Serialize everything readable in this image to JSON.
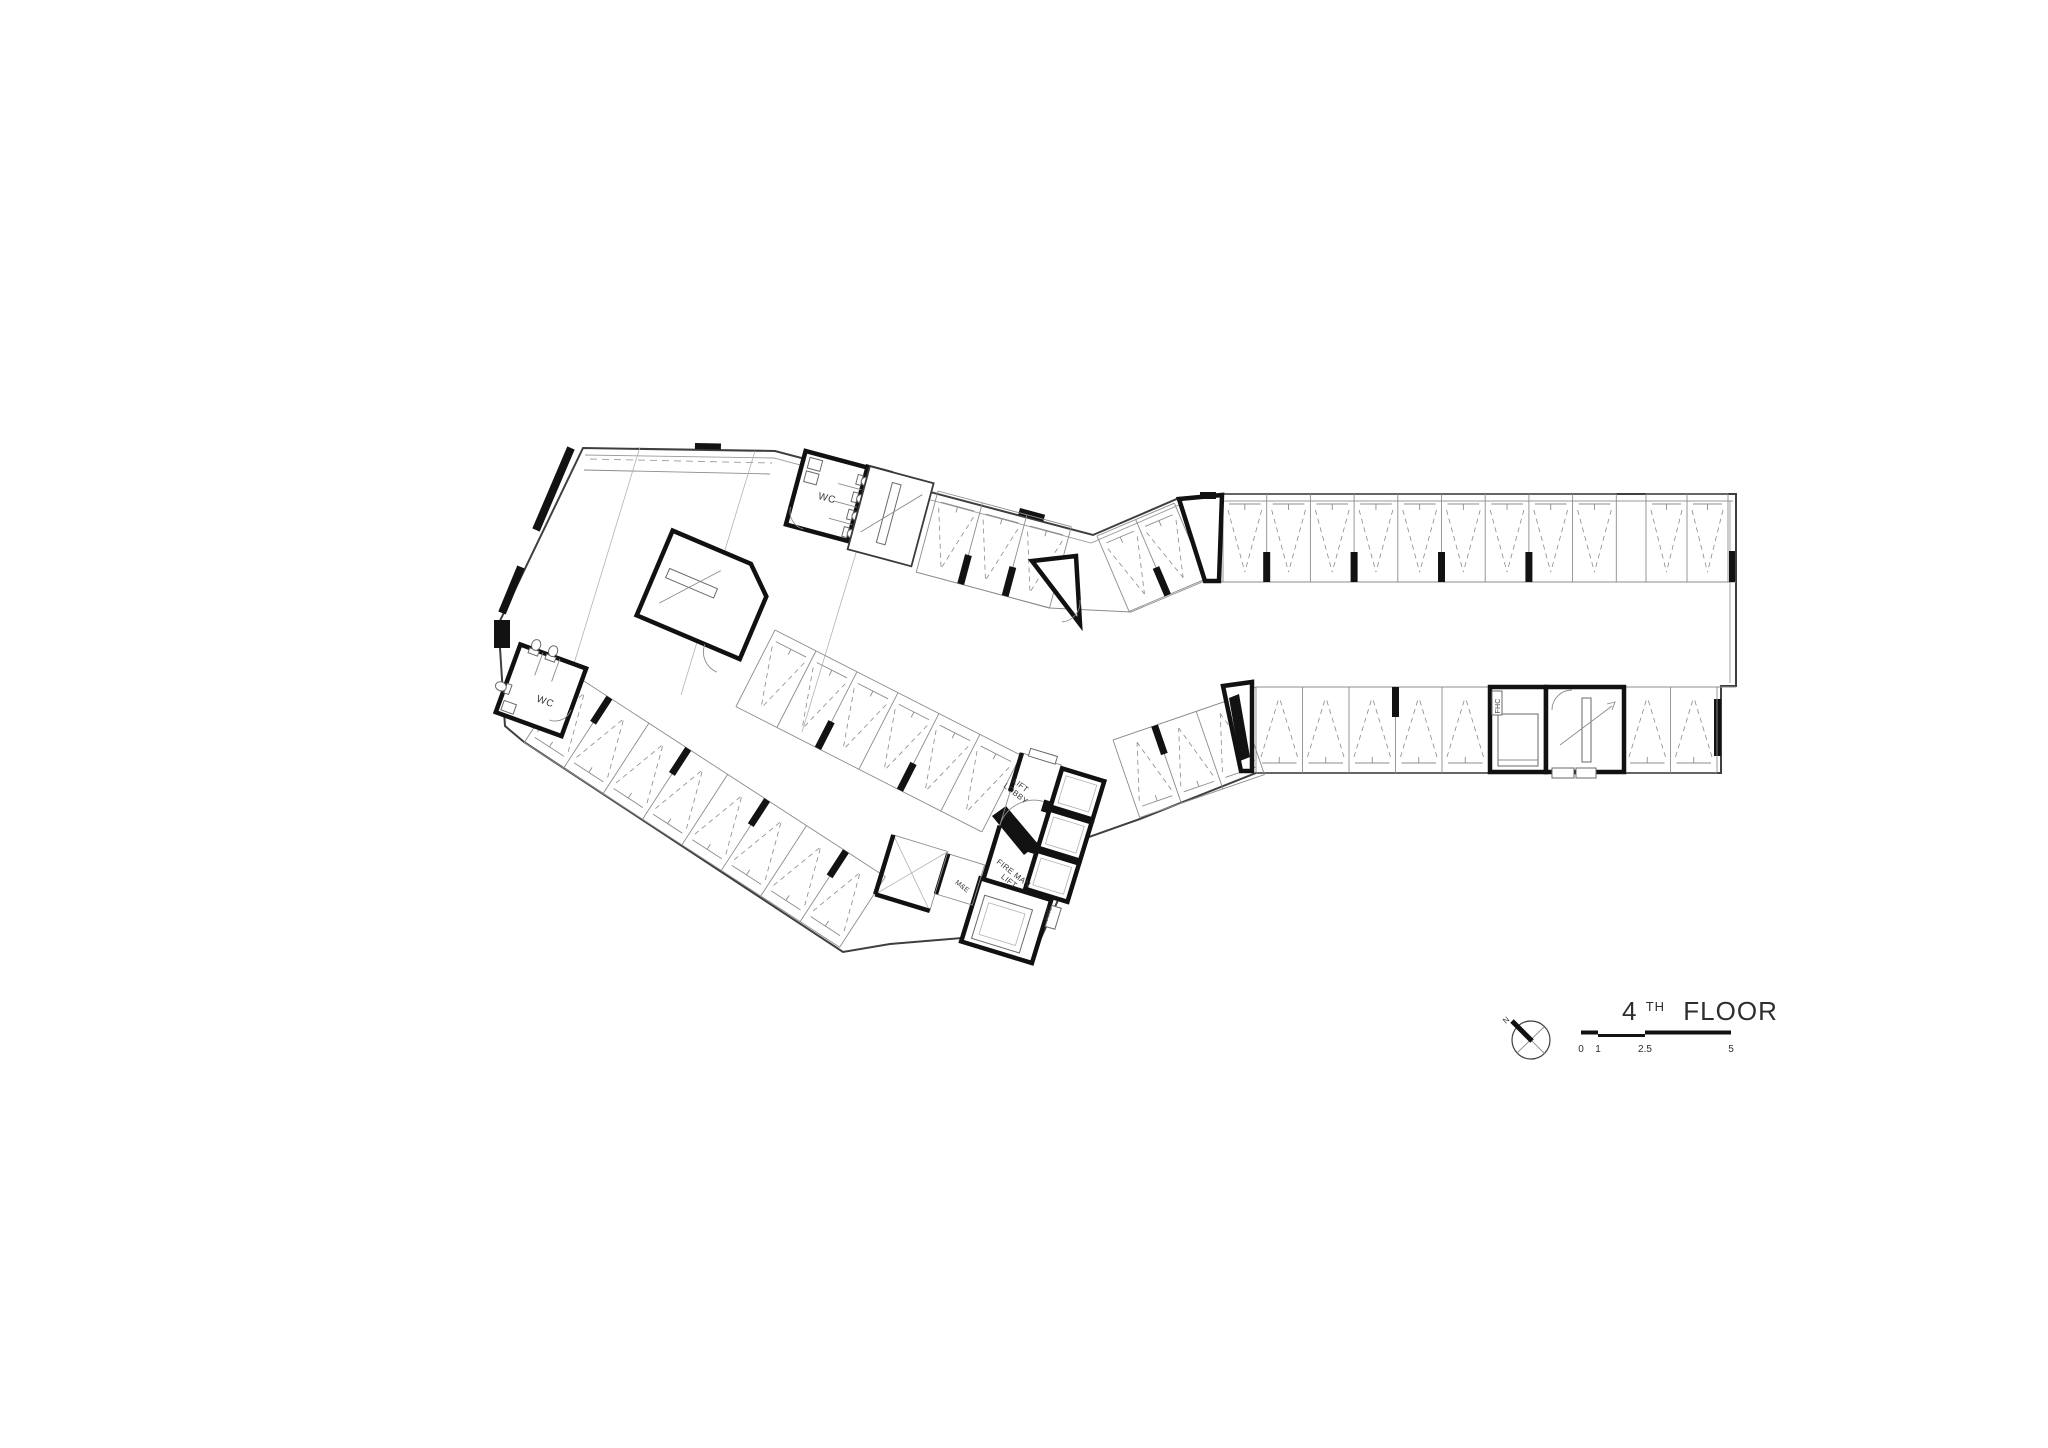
{
  "title_block": {
    "floor_number": "4",
    "floor_ordinal": "TH",
    "floor_label": "FLOOR"
  },
  "scale_bar": {
    "ticks": [
      "0",
      "1",
      "2.5",
      "5"
    ]
  },
  "north": {
    "label": "N"
  },
  "labels": {
    "wc_upper": "WC",
    "wc_lower": "WC",
    "lift_lobby": [
      "LIFT",
      "LOBBY"
    ],
    "fireman_lift": [
      "FIRE MAN",
      "LIFT"
    ],
    "me_room": "M&E",
    "fhc_main": "FHC",
    "fhc_stair": "FHC"
  },
  "parking_rows": [
    {
      "name": "right-wing-top-row-a",
      "x": 1223,
      "y": 494,
      "rot": 0,
      "count": 9,
      "w": 43.7,
      "depth": 88,
      "apex": "down",
      "cols": [
        1,
        3,
        5,
        7
      ]
    },
    {
      "name": "right-wing-top-row-b",
      "x": 1646,
      "y": 494,
      "rot": 0,
      "count": 2,
      "w": 41,
      "depth": 88,
      "apex": "down",
      "cols": []
    },
    {
      "name": "right-wing-bottom-row-left",
      "x": 1256,
      "y": 687,
      "rot": 0,
      "count": 5,
      "w": 46.5,
      "depth": 86,
      "apex": "up",
      "cols": [
        3
      ]
    },
    {
      "name": "right-wing-bottom-row-right",
      "x": 1624,
      "y": 687,
      "rot": 0,
      "count": 2,
      "w": 46.5,
      "depth": 86,
      "apex": "up",
      "cols": []
    },
    {
      "name": "upper-connector-stalls",
      "x": 1097,
      "y": 536,
      "rot": -23,
      "count": 2,
      "w": 42,
      "depth": 82,
      "apex": "down",
      "cols": [
        1
      ]
    },
    {
      "name": "left-wing-top-band",
      "x": 938,
      "y": 491,
      "rot": 15,
      "count": 3,
      "w": 46,
      "depth": 84,
      "apex": "down",
      "cols": [
        1,
        2
      ]
    },
    {
      "name": "left-wing-middle-band",
      "x": 775,
      "y": 630,
      "rot": 27,
      "count": 6,
      "w": 46,
      "depth": 86,
      "apex": "down",
      "cols": [
        2,
        4
      ]
    },
    {
      "name": "left-wing-bottom-band",
      "x": 570,
      "y": 672,
      "rot": 33,
      "count": 8,
      "w": 47,
      "depth": 84,
      "apex": "up",
      "cols": [
        1,
        3,
        5,
        7
      ]
    },
    {
      "name": "lower-connector-stalls",
      "x": 1113,
      "y": 740,
      "rot": -19,
      "count": 3,
      "w": 44,
      "depth": 82,
      "apex": "up",
      "cols": [
        1
      ]
    }
  ],
  "stairs": [
    {
      "name": "stair-treads-top",
      "x": 866,
      "y": 464,
      "len": 58,
      "step": 7.5,
      "count": 10,
      "dir": "h",
      "rot": "15 835 492"
    },
    {
      "name": "stair-treads-middle",
      "x": 660,
      "y": 554,
      "len": 60,
      "step": 7,
      "count": 9,
      "dir": "v",
      "rot": "23 705 590"
    },
    {
      "name": "stair-treads-right",
      "x": 1554,
      "y": 700,
      "len": 62,
      "step": 7.4,
      "count": 9,
      "dir": "h",
      "rot": ""
    }
  ]
}
